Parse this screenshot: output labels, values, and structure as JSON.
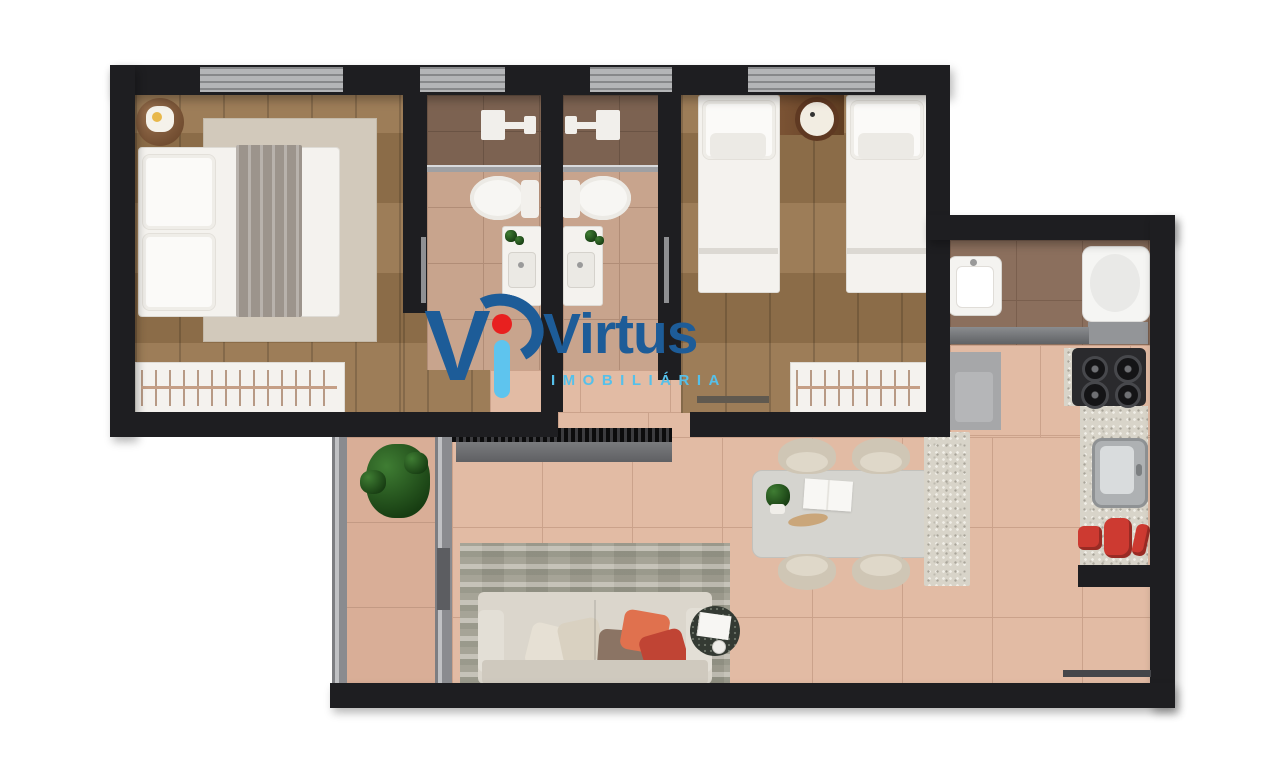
{
  "logo": {
    "monogram_v": "V",
    "name": "Virtus",
    "subtitle": "IMOBILIÁRIA"
  },
  "brand_colors": {
    "dark_blue": "#1d5c98",
    "light_blue": "#5ec4ee",
    "red": "#e8201f"
  },
  "palette": {
    "wall": "#1e1e21",
    "window_gray": "#b4b5b7",
    "wood_floor": "#97754e",
    "bath_tile": "#c8a48d",
    "shower_tile": "#7c6251",
    "living_tile": "#e2bba4",
    "service_tile": "#8b6f5d",
    "granite_counter": "#d8d4c9",
    "red_appliances": "#cd3a31"
  },
  "floorplan": {
    "type": "apartment-top-view-render",
    "rooms": [
      {
        "name": "bedroom-1",
        "furniture": [
          "double-bed",
          "pillows",
          "throw-blanket",
          "area-rug",
          "round-side-table",
          "wardrobe-hanger-rail"
        ]
      },
      {
        "name": "bathroom-1",
        "furniture": [
          "shower-fixture",
          "glass-partition",
          "toilet",
          "vanity-sink",
          "small-plant",
          "towel-bar"
        ]
      },
      {
        "name": "bathroom-2",
        "furniture": [
          "shower-fixture",
          "glass-partition",
          "toilet",
          "vanity-sink",
          "small-plant",
          "towel-bar"
        ]
      },
      {
        "name": "bedroom-2",
        "furniture": [
          "single-bed",
          "single-bed",
          "nightstand",
          "clock",
          "wardrobe-hanger-rail",
          "low-bench"
        ]
      },
      {
        "name": "laundry-service",
        "furniture": [
          "laundry-tub",
          "washing-machine",
          "gray-counter"
        ]
      },
      {
        "name": "kitchen",
        "furniture": [
          "refrigerator",
          "wall-cabinet",
          "stove-4-burners",
          "granite-countertop",
          "sink",
          "red-small-appliances"
        ]
      },
      {
        "name": "living-dining",
        "furniture": [
          "tv-console",
          "sofa",
          "throw-pillows",
          "distressed-rug",
          "round-side-table",
          "dining-table",
          "dining-chairs-x4",
          "granite-peninsula"
        ]
      },
      {
        "name": "balcony",
        "furniture": [
          "potted-plant",
          "sliding-glass-door"
        ]
      }
    ],
    "window_count": 4,
    "entry_threshold": "bottom-right"
  }
}
